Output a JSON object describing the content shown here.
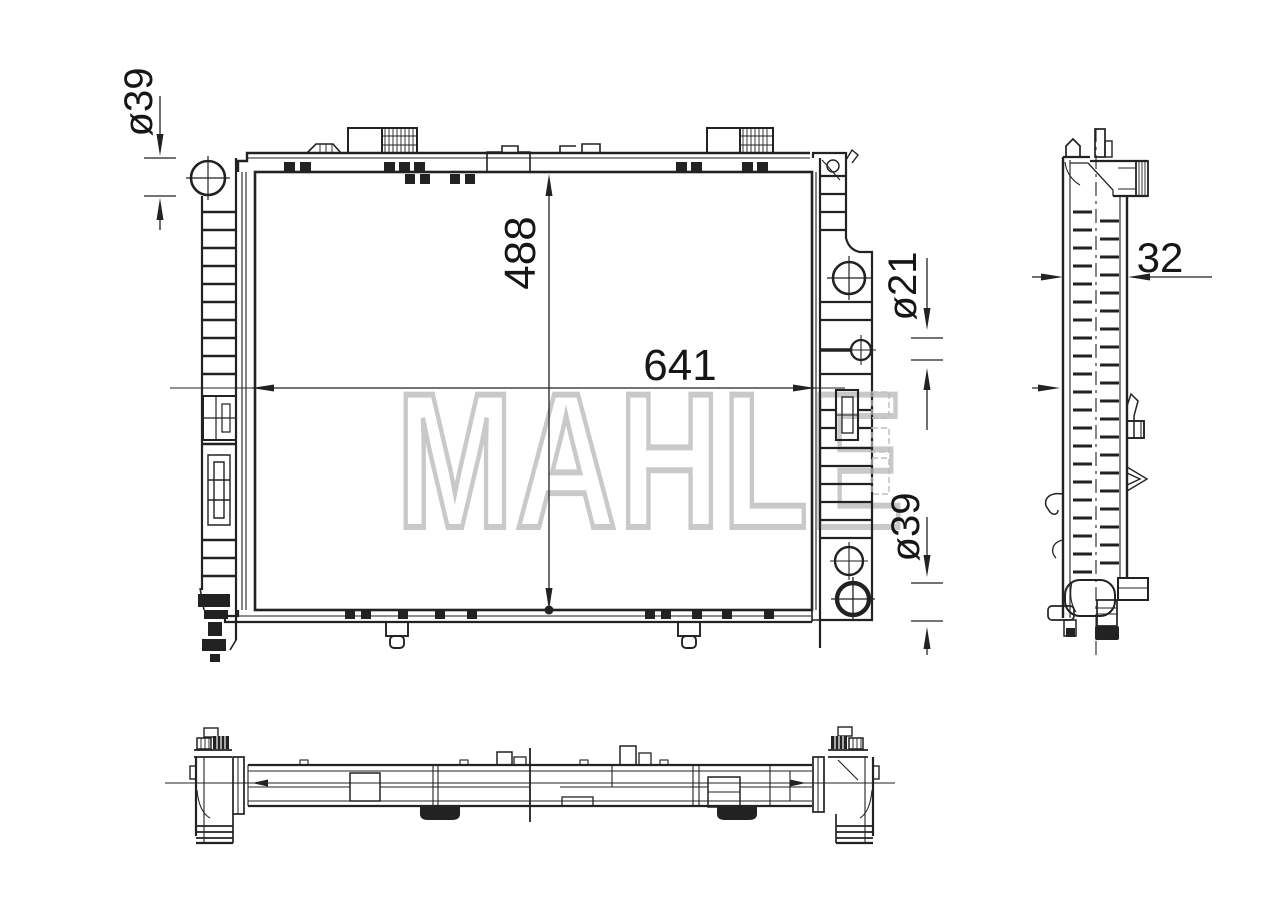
{
  "page": {
    "background": "#ffffff"
  },
  "drawing": {
    "line_color": "#222222",
    "watermark": {
      "text": "MAHLE",
      "color": "#c9c9c9"
    },
    "dimensions": {
      "top_left_port": "ø39",
      "core_height": "488",
      "core_width": "641",
      "right_pipe": "ø21",
      "bottom_right_port": "ø39",
      "depth": "32"
    }
  }
}
